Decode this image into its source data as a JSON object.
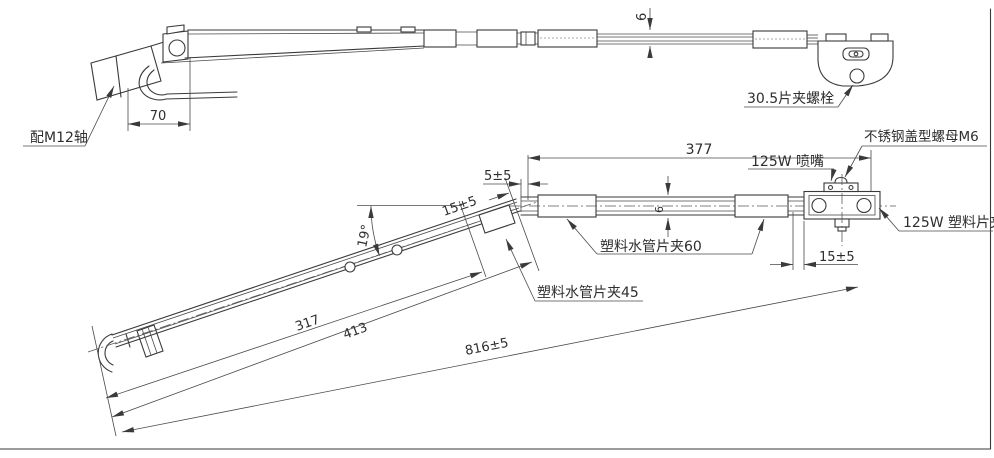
{
  "top_view": {
    "labels": {
      "shaft": "配M12轴",
      "clamp_bolt": "30.5片夹螺栓"
    },
    "dimensions": {
      "head_length": "70",
      "profile_height": "6"
    }
  },
  "front_view": {
    "labels": {
      "nozzle": "125W 喷嘴",
      "cap_nut": "不锈钢盖型螺母M6",
      "plastic_clip": "125W 塑料片夹",
      "pipe_clip_60": "塑料水管片夹60",
      "pipe_clip_45": "塑料水管片夹45"
    },
    "dimensions": {
      "straight_length": "377",
      "bend_gap": "5±5",
      "bend_length": "15±5",
      "arm_angle": "19°",
      "length_to_clip": "317",
      "length_to_bend": "413",
      "total_length": "816±5",
      "end_offset": "15±5",
      "tube_diameter": "6"
    }
  }
}
